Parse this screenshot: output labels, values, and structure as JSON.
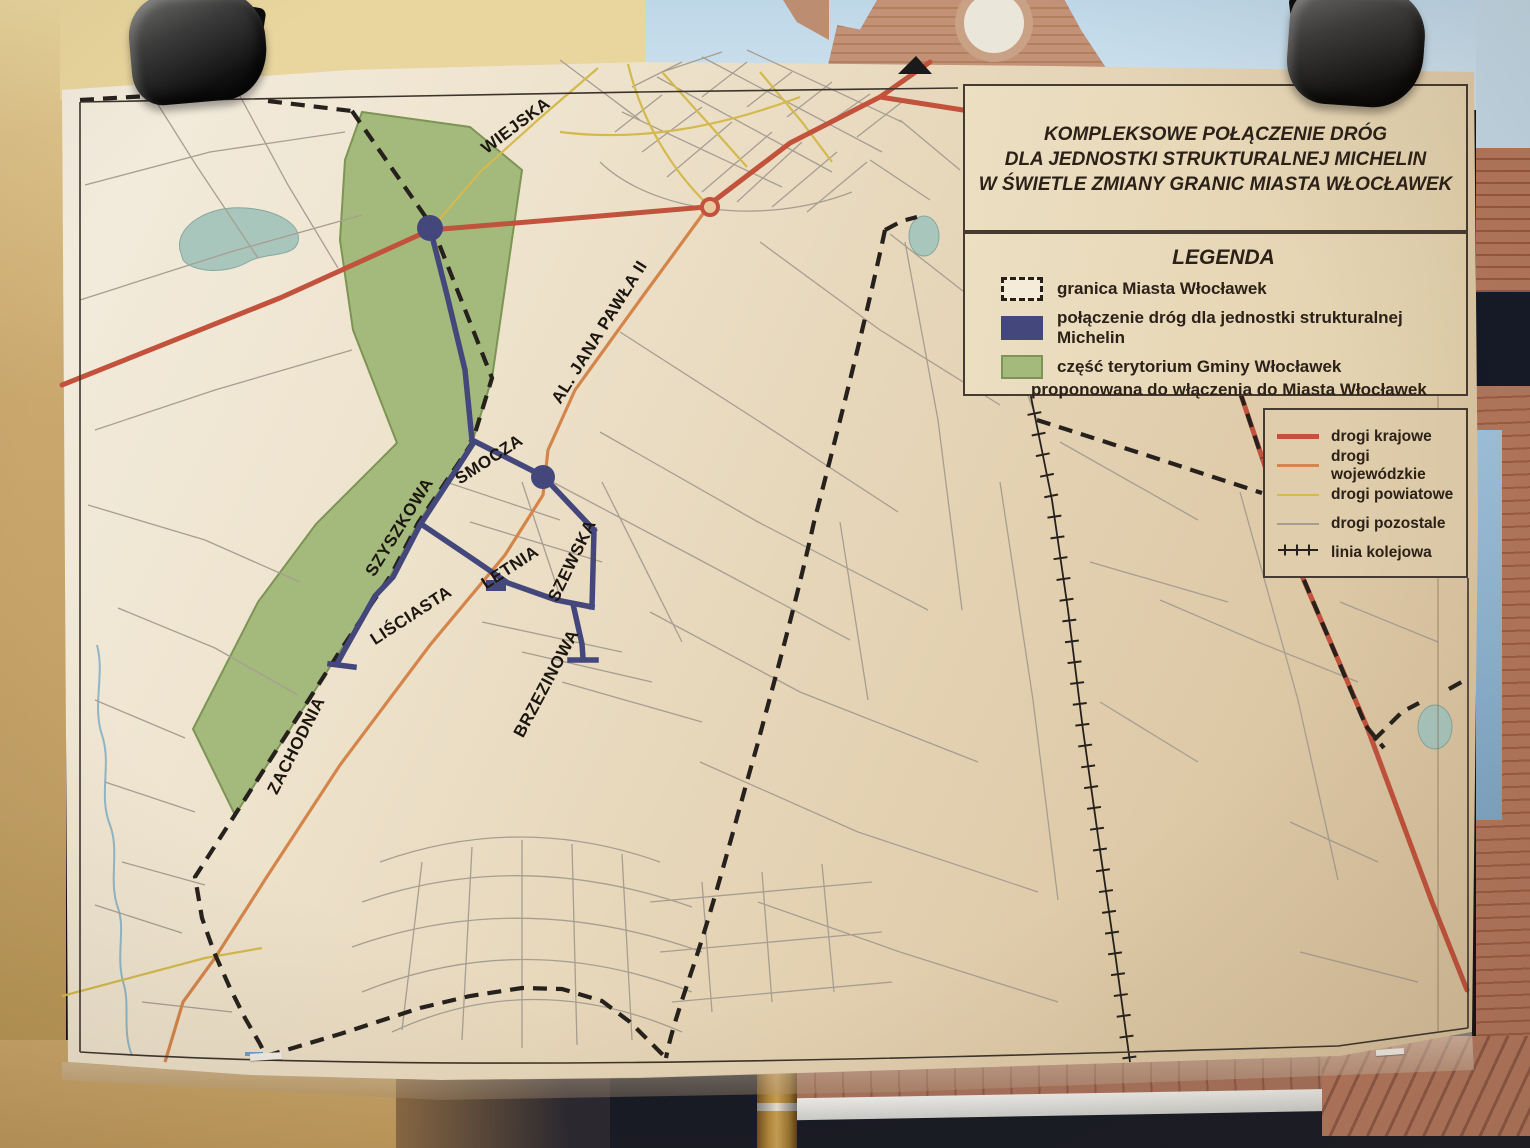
{
  "colors": {
    "navy": "#44477c",
    "green-fill": "#a4ba7c",
    "green-border": "#7d9455",
    "road-national": "#c2523c",
    "road-regional": "#d4854a",
    "road-county": "#d3b94e",
    "road-other": "#a79e92",
    "railway": "#26211c",
    "boundary": "#26211c",
    "water": "#a9c6bd"
  },
  "title_box": {
    "lines": [
      "KOMPLEKSOWE POŁĄCZENIE DRÓG",
      "DLA JEDNOSTKI STRUKTURALNEJ MICHELIN",
      "W ŚWIETLE ZMIANY GRANIC MIASTA WŁOCŁAWEK"
    ]
  },
  "legend": {
    "heading": "LEGENDA",
    "items": [
      {
        "label": "granica Miasta Włocławek"
      },
      {
        "label": "połączenie dróg dla jednostki strukturalnej Michelin"
      },
      {
        "label": "część terytorium Gminy Włocławek",
        "label2": "proponowana do włączenia do Miasta Włocławek"
      }
    ]
  },
  "road_legend": {
    "items": [
      {
        "label": "drogi krajowe"
      },
      {
        "label": "drogi wojewódzkie"
      },
      {
        "label": "drogi powiatowe"
      },
      {
        "label": "drogi pozostale"
      },
      {
        "label": "linia kolejowa"
      }
    ]
  },
  "map": {
    "street_labels": [
      {
        "text": "WIEJSKA"
      },
      {
        "text": "AL. JANA PAWŁA II"
      },
      {
        "text": "SMOCZA"
      },
      {
        "text": "SZYSZKOWA"
      },
      {
        "text": "SZEWSKA"
      },
      {
        "text": "LETNIA"
      },
      {
        "text": "LIŚCIASTA"
      },
      {
        "text": "BRZEZINOWA"
      },
      {
        "text": "ZACHODNIA"
      }
    ]
  }
}
